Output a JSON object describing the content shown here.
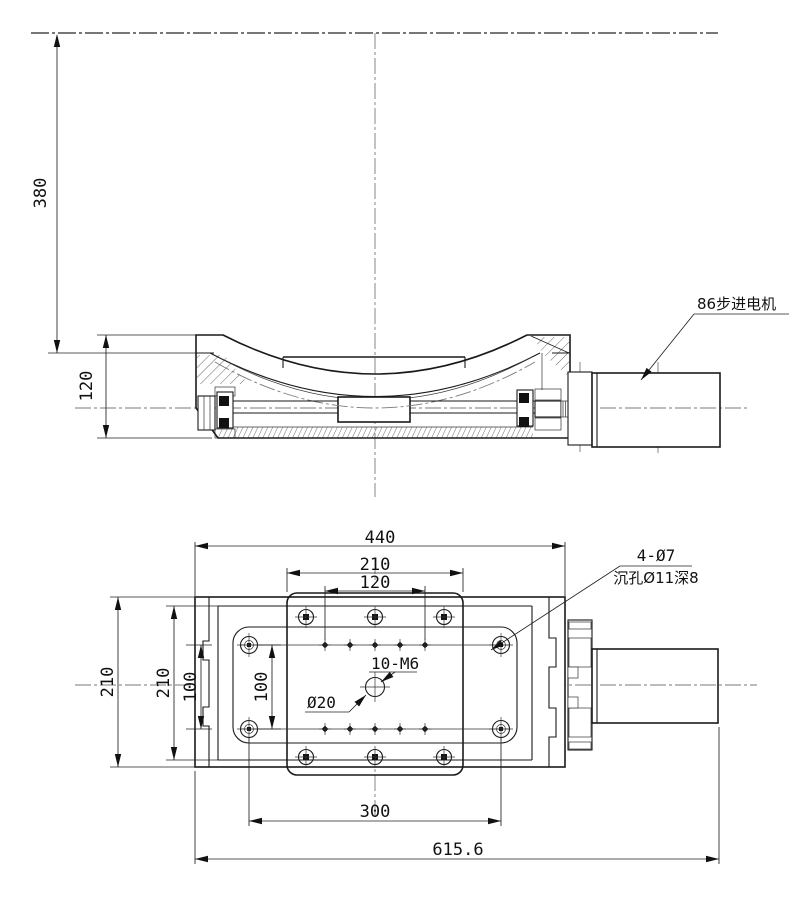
{
  "drawing": {
    "type": "engineering-drawing",
    "component": "motorized goniometer stage with stepper motor",
    "colors": {
      "line": "#1a1a1a",
      "centerline": "#7a7a7a",
      "background": "#ffffff"
    },
    "side": {
      "dim_380": "380",
      "dim_120": "120",
      "motor_label": "86步进电机"
    },
    "plan": {
      "dim_440": "440",
      "dim_210_top": "210",
      "dim_120": "120",
      "dim_210_left_outer": "210",
      "dim_210_left_inner": "210",
      "dim_100_outer": "100",
      "dim_100_inner": "100",
      "dim_300": "300",
      "dim_615_6": "615.6",
      "label_10_m6": "10-M6",
      "label_d20": "Ø20",
      "label_4_d7": "4-Ø7",
      "label_counterbore": "沉孔Ø11深8"
    }
  }
}
